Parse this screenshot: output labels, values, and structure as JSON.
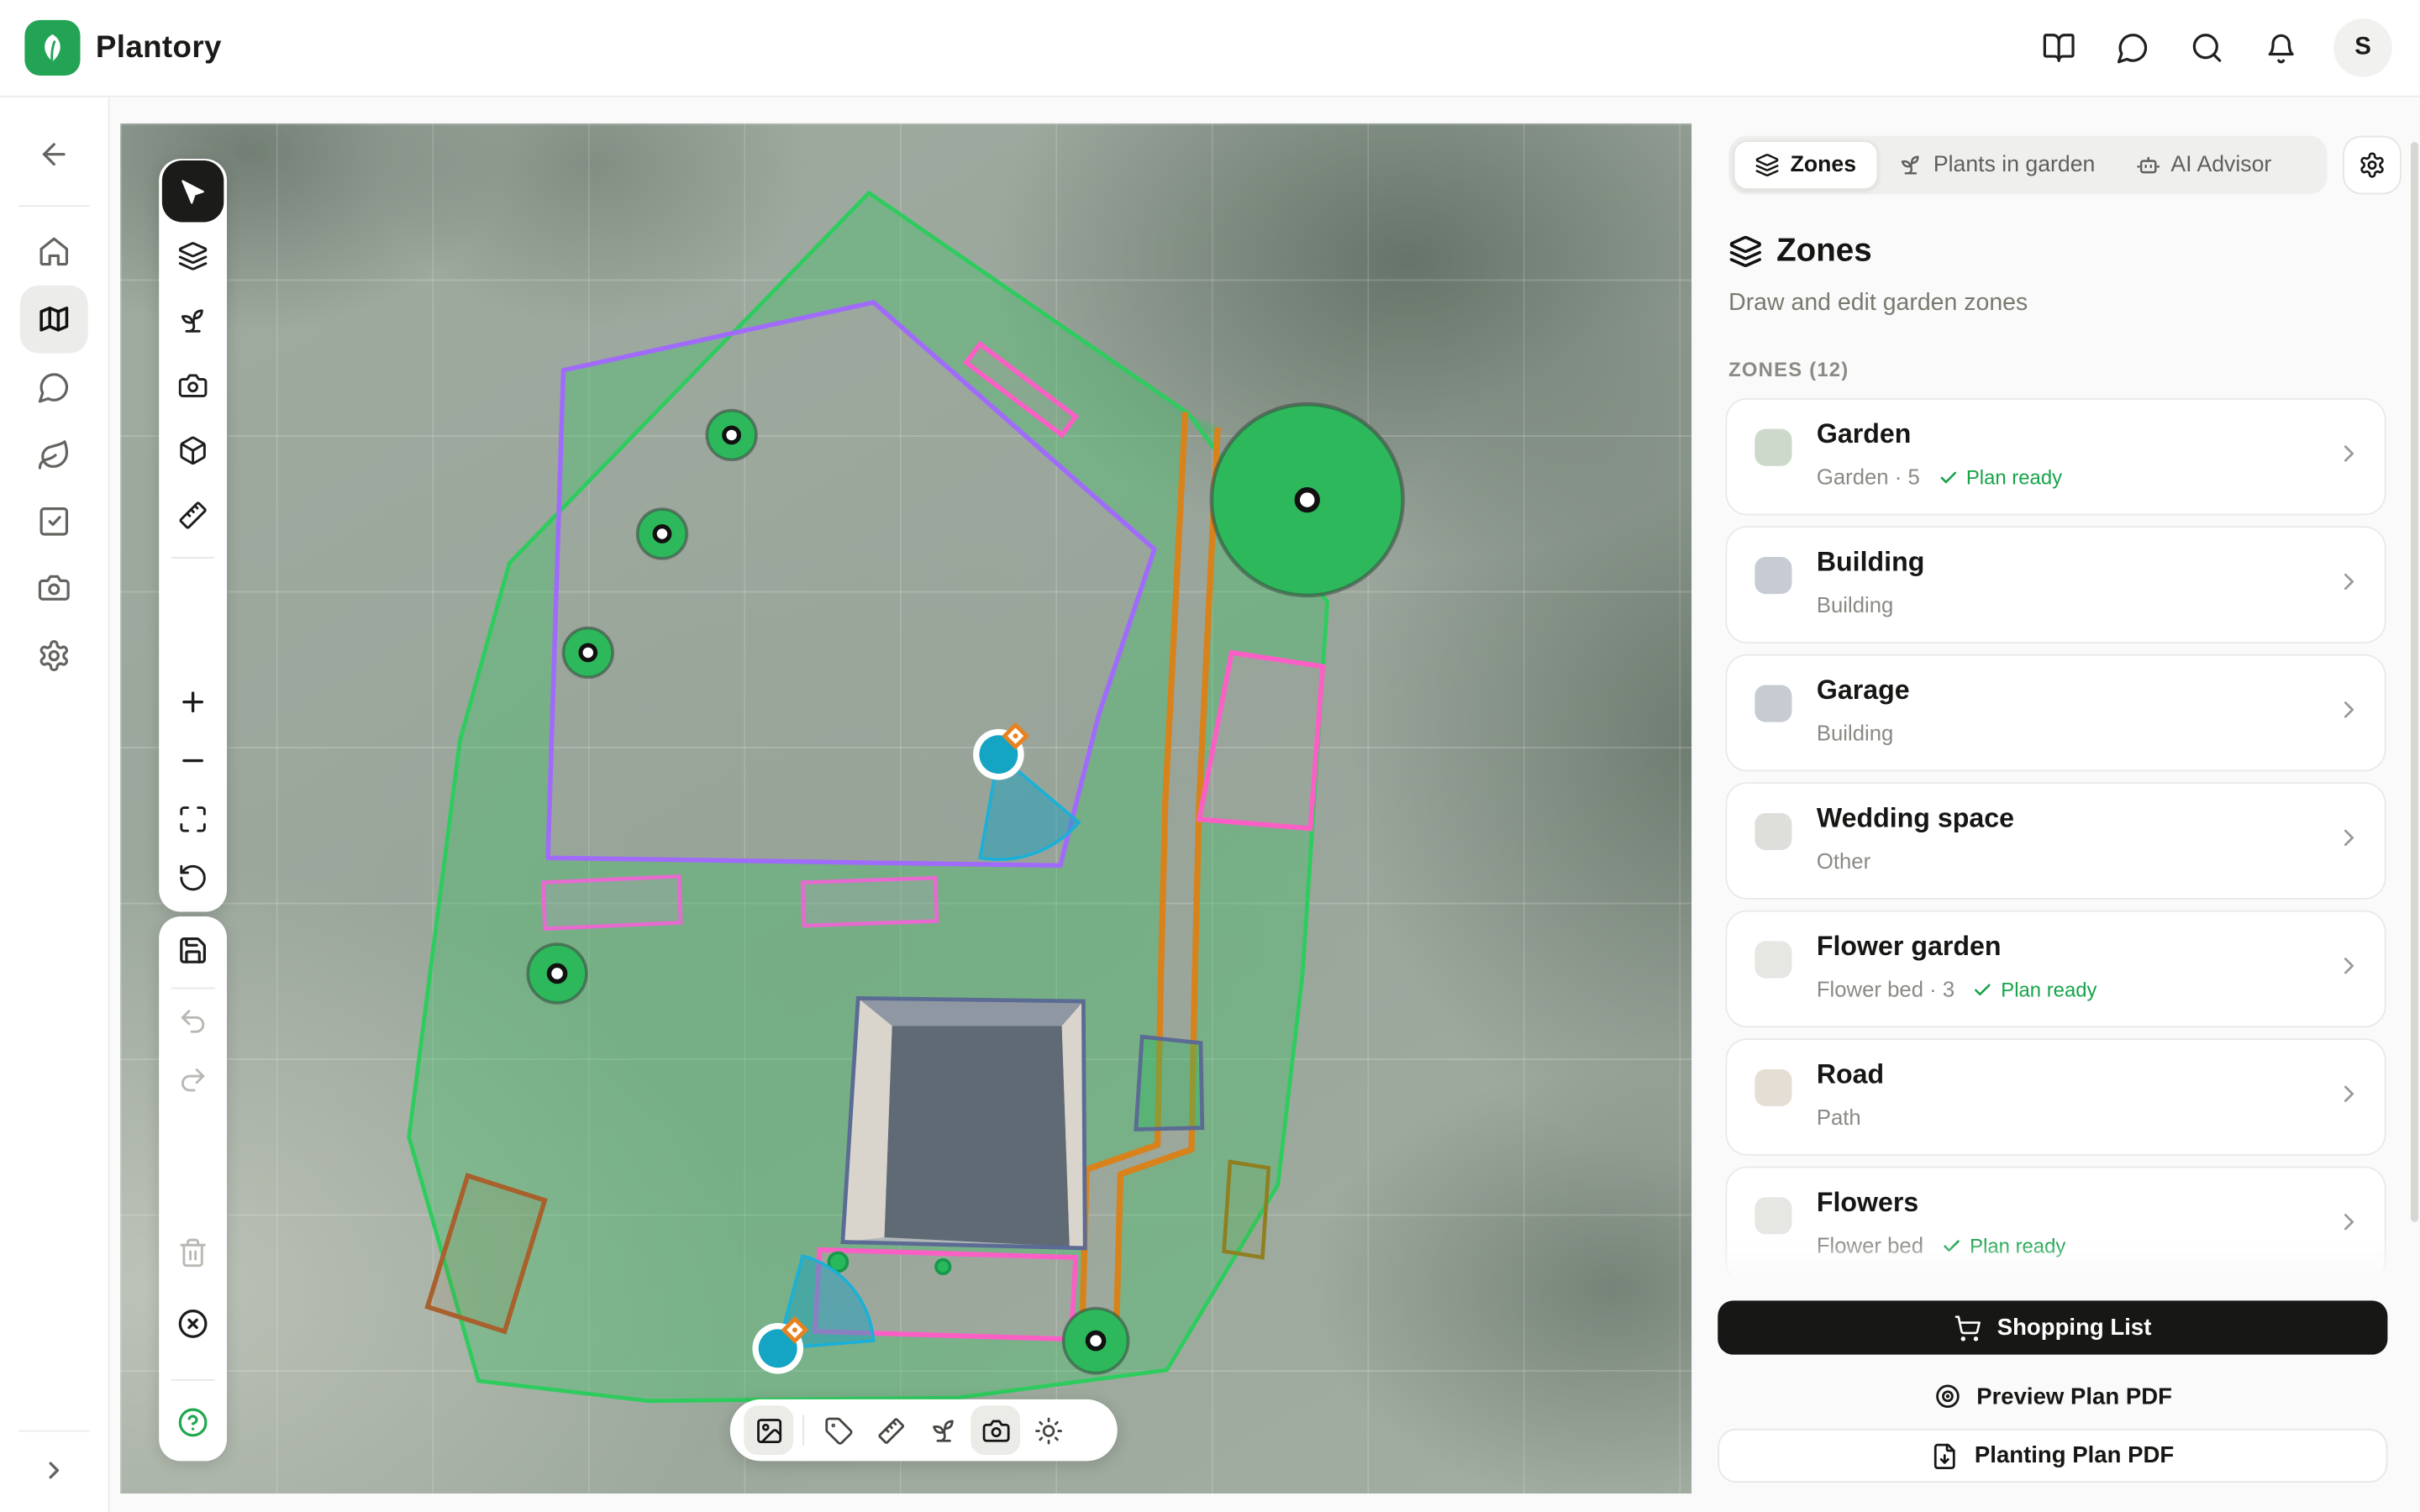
{
  "header": {
    "brand": "Plantory",
    "avatar_initial": "S",
    "icons": [
      "library-icon",
      "messages-icon",
      "search-icon",
      "notifications-icon"
    ]
  },
  "sidebar": {
    "items": [
      "back",
      "home",
      "map",
      "messages",
      "plants",
      "tasks",
      "photos",
      "settings",
      "expand"
    ]
  },
  "left_toolbar": {
    "group1": [
      "select",
      "layers",
      "plant",
      "photo",
      "objects-3d",
      "measure",
      "zoom-in",
      "zoom-out",
      "fit-view",
      "reset-view"
    ],
    "group2": [
      "save",
      "undo",
      "redo",
      "delete",
      "cancel",
      "help"
    ]
  },
  "bottom_toolbar": {
    "tools": [
      "background-image",
      "labels",
      "measurements",
      "plants",
      "photos",
      "sun"
    ]
  },
  "panel": {
    "tabs": [
      {
        "label": "Zones",
        "active": true
      },
      {
        "label": "Plants in garden",
        "active": false
      },
      {
        "label": "AI Advisor",
        "active": false
      }
    ],
    "title": "Zones",
    "subtitle": "Draw and edit garden zones",
    "list_label": "ZONES (12)",
    "plan_ready_label": "Plan ready",
    "zones": [
      {
        "name": "Garden",
        "meta": "Garden · 5",
        "plan_ready": true,
        "swatch": "#ccd9cb"
      },
      {
        "name": "Building",
        "meta": "Building",
        "plan_ready": false,
        "swatch": "#c6cbd4"
      },
      {
        "name": "Garage",
        "meta": "Building",
        "plan_ready": false,
        "swatch": "#c7ccd3"
      },
      {
        "name": "Wedding space",
        "meta": "Other",
        "plan_ready": false,
        "swatch": "#dededb"
      },
      {
        "name": "Flower garden",
        "meta": "Flower bed · 3",
        "plan_ready": true,
        "swatch": "#e6e6e3"
      },
      {
        "name": "Road",
        "meta": "Path",
        "plan_ready": false,
        "swatch": "#e5ded4"
      },
      {
        "name": "Flowers",
        "meta": "Flower bed",
        "plan_ready": true,
        "swatch": "#e6e6e3"
      }
    ],
    "footer": {
      "shopping": "Shopping List",
      "preview": "Preview Plan PDF",
      "planting": "Planting Plan PDF"
    }
  },
  "map": {
    "markers": {
      "trees": 6,
      "cameras": 2,
      "plants": 2
    },
    "colors": {
      "brand_green": "#23a455",
      "garden_stroke": "#2ecc5e",
      "garden_fill": "rgba(46,196,94,0.32)",
      "wedding_purple": "#a06bfa",
      "road_orange": "#d8821b",
      "zone_pink": "#fb5fc5",
      "bed_violet": "#e86ad0",
      "camera_teal": "#17a2c0",
      "building_slate": "#5b6b94",
      "planter_brown": "#a8602c",
      "planter_olive": "#8f7f20",
      "tree_green": "#2eb85c"
    }
  }
}
